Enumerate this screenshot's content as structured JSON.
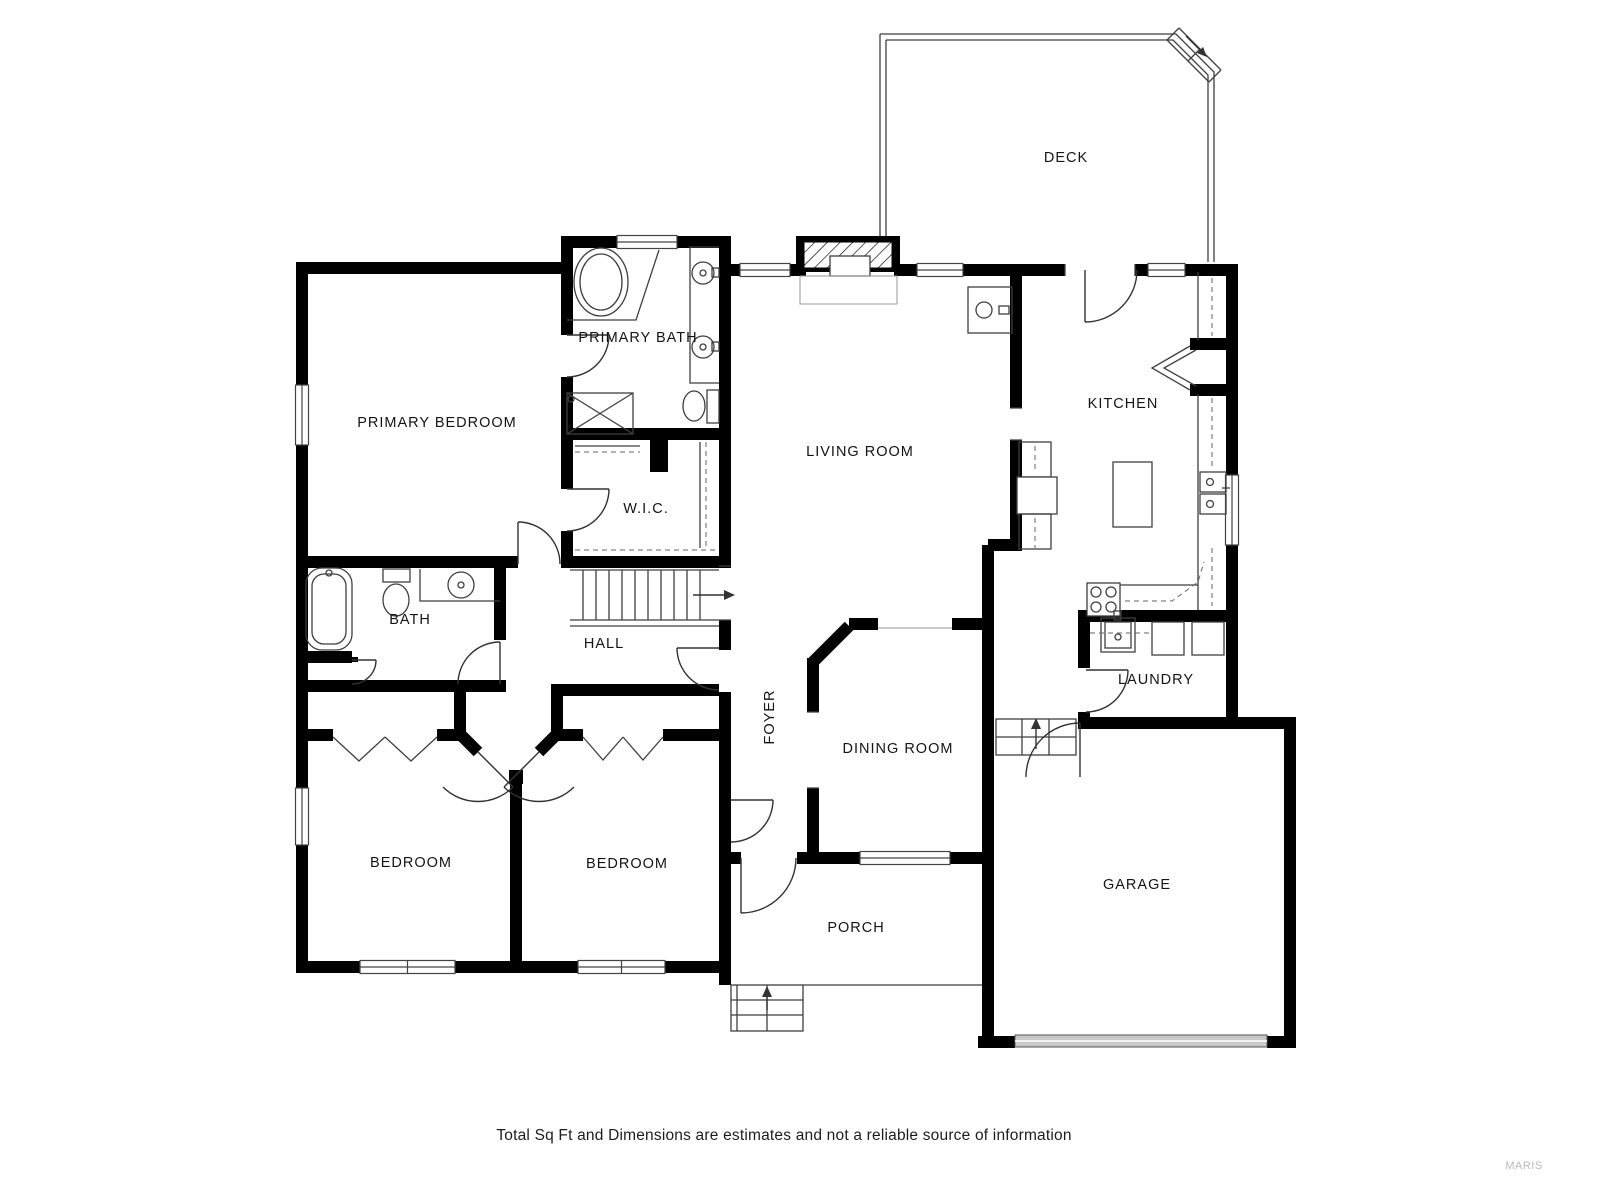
{
  "floorplan": {
    "rooms": [
      {
        "id": "deck",
        "label": "DECK"
      },
      {
        "id": "primary_bath",
        "label": "PRIMARY BATH"
      },
      {
        "id": "primary_bedroom",
        "label": "PRIMARY BEDROOM"
      },
      {
        "id": "living_room",
        "label": "LIVING ROOM"
      },
      {
        "id": "kitchen",
        "label": "KITCHEN"
      },
      {
        "id": "walk_in_closet",
        "label": "W.I.C."
      },
      {
        "id": "bath",
        "label": "BATH"
      },
      {
        "id": "hall",
        "label": "HALL"
      },
      {
        "id": "foyer",
        "label": "FOYER"
      },
      {
        "id": "dining_room",
        "label": "DINING ROOM"
      },
      {
        "id": "laundry",
        "label": "LAUNDRY"
      },
      {
        "id": "bedroom_left",
        "label": "BEDROOM"
      },
      {
        "id": "bedroom_middle",
        "label": "BEDROOM"
      },
      {
        "id": "porch",
        "label": "PORCH"
      },
      {
        "id": "garage",
        "label": "GARAGE"
      }
    ],
    "colors": {
      "wall": "#000000",
      "background": "#ffffff",
      "thin_line": "#3f3f3f",
      "garage_door": "#c8c8c8",
      "watermark": "#b9b9b9"
    }
  },
  "footer": {
    "disclaimer": "Total Sq Ft and Dimensions are estimates and not a reliable source of information",
    "watermark": "MARIS"
  }
}
